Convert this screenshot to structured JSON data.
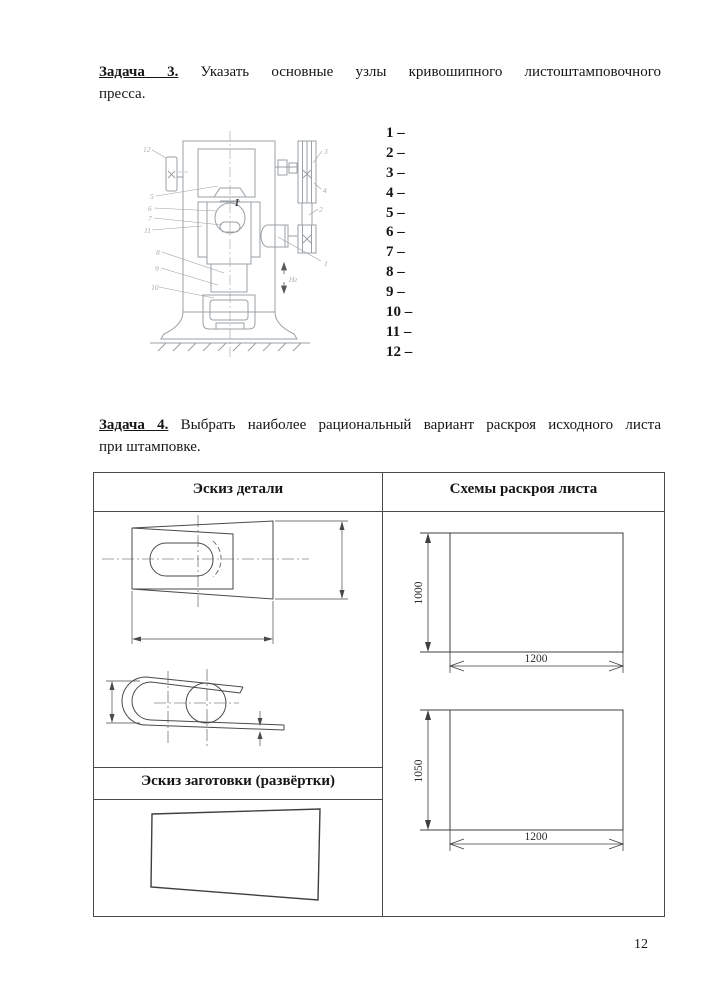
{
  "page": {
    "number": "12"
  },
  "task3": {
    "label": "Задача 3.",
    "line1": "Указать основные узлы кривошипного листоштамповочного",
    "line2": "пресса.",
    "items": [
      "1 –",
      "2 –",
      "3 –",
      "4 –",
      "5 –",
      "6 –",
      "7 –",
      "8 –",
      "9 –",
      "10 –",
      "11 –",
      "12 –"
    ]
  },
  "press": {
    "section_label": "I",
    "stroke_label": "Нг",
    "labels_left": [
      "12",
      "5",
      "6",
      "7",
      "11",
      "8",
      "9",
      "10"
    ],
    "labels_right": [
      "3",
      "4",
      "2",
      "1"
    ]
  },
  "task4": {
    "label": "Задача 4.",
    "line1": "Выбрать наиболее рациональный вариант раскроя исходного листа",
    "line2": "при штамповке."
  },
  "table": {
    "header_left": "Эскиз детали",
    "header_right": "Схемы раскроя листа",
    "subheader": "Эскиз заготовки (развёртки)"
  },
  "layouts": [
    {
      "height": "1000",
      "width": "1200"
    },
    {
      "height": "1050",
      "width": "1200"
    }
  ],
  "colors": {
    "drawing_gray": "#9aa0a4",
    "line_dark": "#3c3c3c",
    "table_border": "#4a4a4a"
  }
}
